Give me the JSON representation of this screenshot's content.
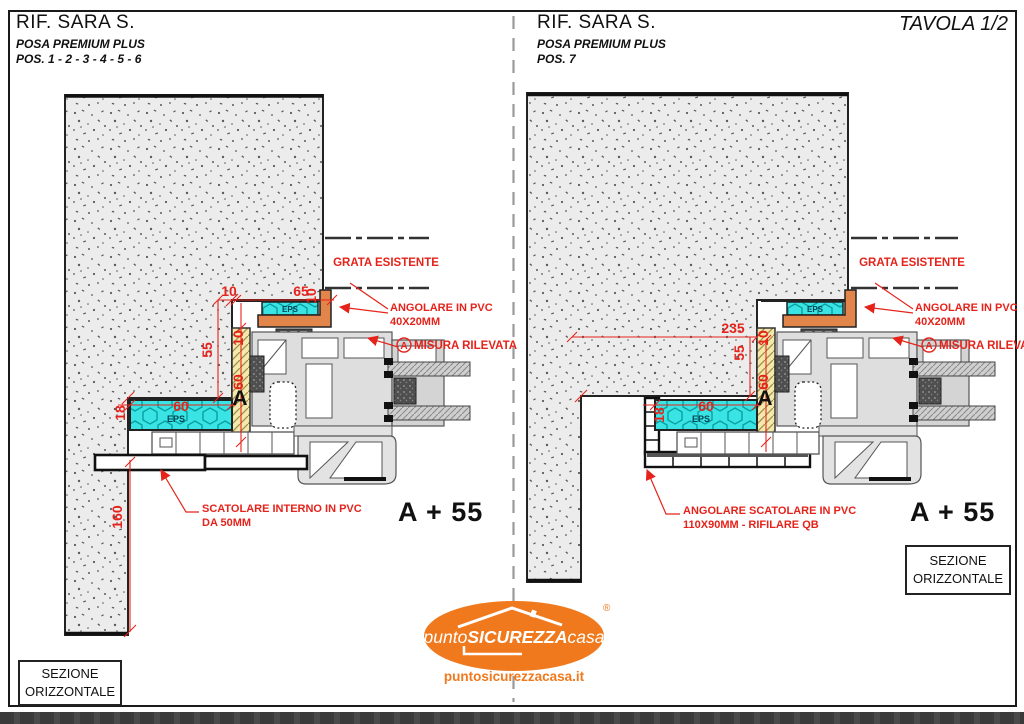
{
  "tavola": "TAVOLA 1/2",
  "header_left": {
    "title": "RIF. SARA S.",
    "subtitle": "POSA PREMIUM PLUS",
    "positions": "POS. 1 - 2 - 3 - 4 - 5 - 6"
  },
  "header_right": {
    "title": "RIF. SARA S.",
    "subtitle": "POSA PREMIUM PLUS",
    "positions": "POS. 7"
  },
  "left": {
    "grata": "GRATA ESISTENTE",
    "angolare1": "ANGOLARE IN PVC",
    "angolare2": "40X20MM",
    "misura_marker": "A",
    "misura": "MISURA RILEVATA",
    "note1": "SCATOLARE INTERNO IN PVC",
    "note2": "DA 50MM",
    "quota": "A + 55",
    "box1": "SEZIONE",
    "box2": "ORIZZONTALE",
    "eps_top": "EPS",
    "eps_bottom": "EPS",
    "dims": {
      "d10a": "10",
      "d65": "65",
      "d10b": "10",
      "d10c": "10",
      "d55": "55",
      "d60y": "60",
      "d60c": "60",
      "d18": "18",
      "d160": "160",
      "marker": "A"
    }
  },
  "right": {
    "grata": "GRATA ESISTENTE",
    "angolare1": "ANGOLARE IN PVC",
    "angolare2": "40X20MM",
    "misura_marker": "A",
    "misura": "MISURA RILEVATA",
    "note1": "ANGOLARE SCATOLARE IN PVC",
    "note2": "110X90MM - RIFILARE QB",
    "quota": "A + 55",
    "box1": "SEZIONE",
    "box2": "ORIZZONTALE",
    "eps_top": "EPS",
    "eps_bottom": "EPS",
    "dims": {
      "d235": "235",
      "d10c": "10",
      "d55": "55",
      "d60y": "60",
      "d60c": "60",
      "d18": "18",
      "marker": "A"
    }
  },
  "logo": {
    "punto": "punto",
    "sicurezza": "SICUREZZA",
    "casa": "casa",
    "reg": "®",
    "site": "puntosicurezzacasa.it"
  },
  "colors": {
    "annotation_red": "#e5231b",
    "eps_cyan": "#3ae4e4",
    "angolare_orange": "#e2854b",
    "insulation_yellow": "#f4e8ac",
    "logo_orange": "#f0791d",
    "wall_fill": "#ececec"
  }
}
